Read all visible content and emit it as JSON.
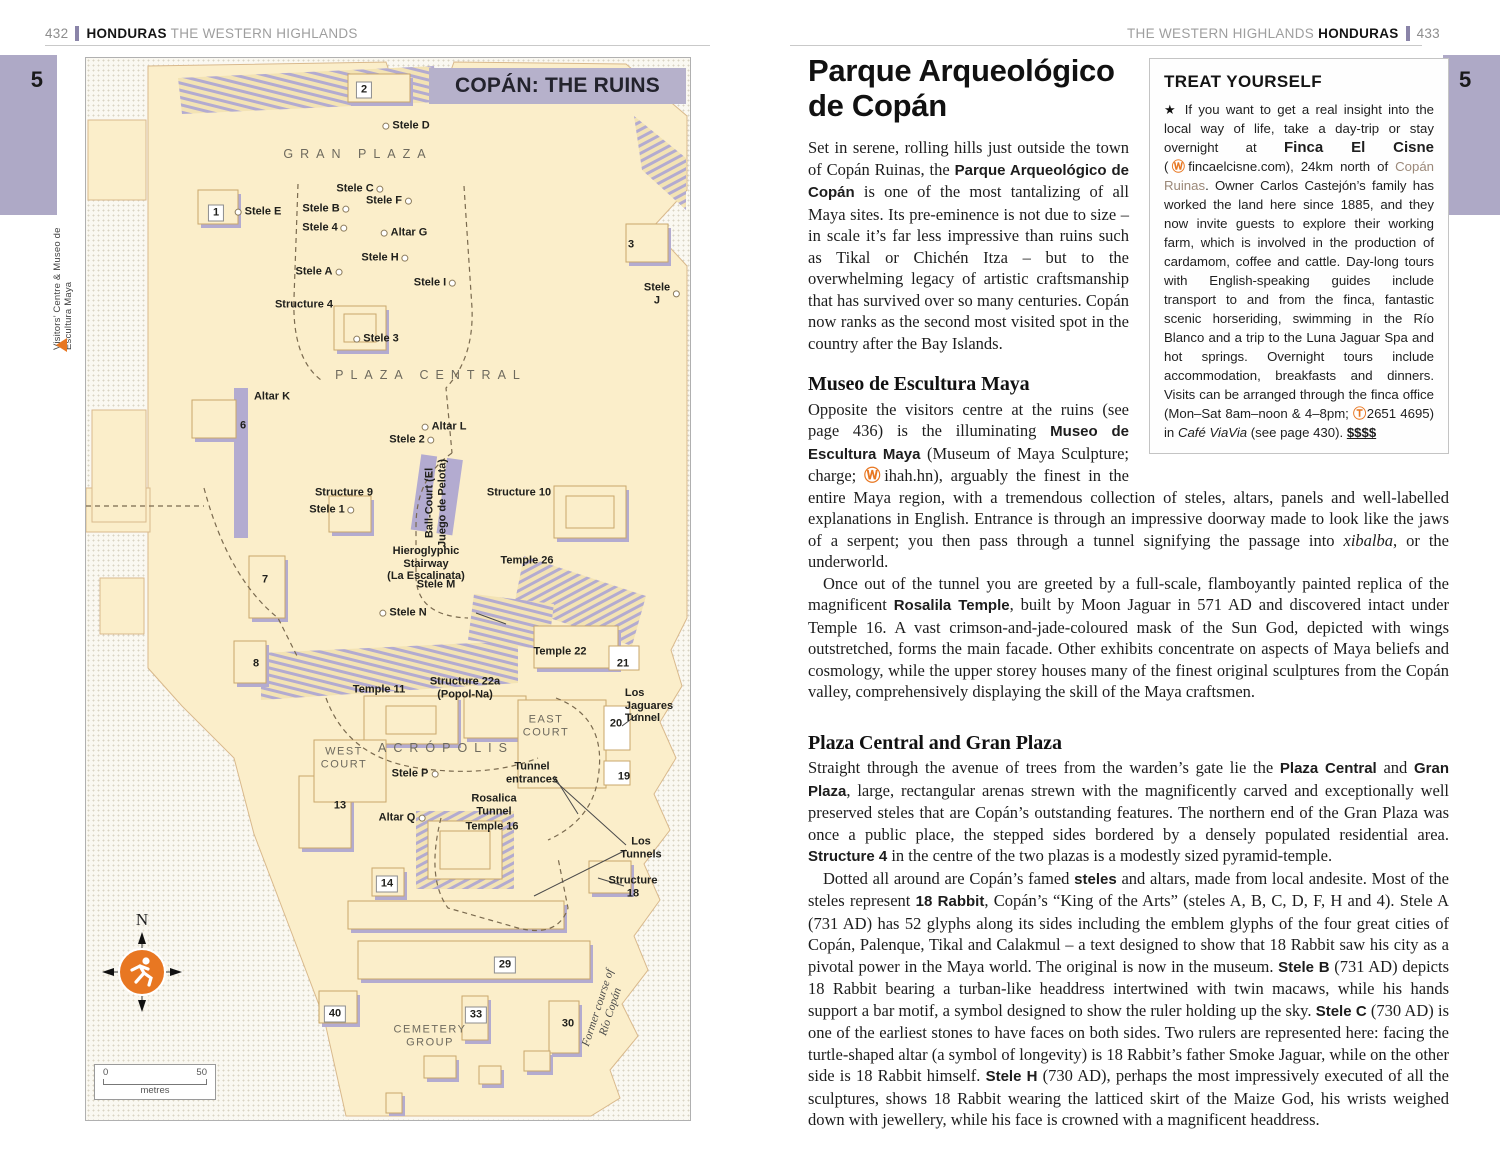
{
  "colors": {
    "accent_orange": "#e87722",
    "tab_purple": "#aea9c6",
    "map_cream": "#fbeeca",
    "map_shadow": "#b3abd0",
    "title_box": "#b6b1cb"
  },
  "page_left": {
    "page_number": "432",
    "header_bold": "HONDURAS",
    "header_light": "THE WESTERN HIGHLANDS",
    "tab": "5",
    "map": {
      "title": "COPÁN: THE RUINS",
      "side_label": "Visitors’ Centre & Museo de Escultura Maya",
      "compass_n": "N",
      "scale_zero": "0",
      "scale_fifty": "50",
      "scale_unit": "metres",
      "labels": [
        {
          "t": "2",
          "cls": "numbox",
          "x": 278,
          "y": 32
        },
        {
          "t": "Stele D",
          "dot": "l",
          "x": 320,
          "y": 68
        },
        {
          "t": "GRAN PLAZA",
          "cls": "area",
          "x": 272,
          "y": 96
        },
        {
          "t": "Stele C",
          "dot": "r",
          "x": 274,
          "y": 131
        },
        {
          "t": "1",
          "cls": "numbox",
          "x": 130,
          "y": 155
        },
        {
          "t": "Stele E",
          "dot": "l",
          "x": 172,
          "y": 154
        },
        {
          "t": "Stele B",
          "dot": "r",
          "x": 240,
          "y": 151
        },
        {
          "t": "Stele F",
          "dot": "r",
          "x": 303,
          "y": 143
        },
        {
          "t": "Stele 4",
          "dot": "r",
          "x": 239,
          "y": 170
        },
        {
          "t": "Altar G",
          "dot": "l",
          "x": 318,
          "y": 175
        },
        {
          "t": "Stele H",
          "dot": "r",
          "x": 299,
          "y": 200
        },
        {
          "t": "Stele A",
          "dot": "r",
          "x": 233,
          "y": 214
        },
        {
          "t": "Stele I",
          "dot": "r",
          "x": 349,
          "y": 225
        },
        {
          "t": "3",
          "x": 545,
          "y": 187
        },
        {
          "t": "Stele J",
          "dot": "r",
          "x": 576,
          "y": 236
        },
        {
          "t": "Structure 4",
          "x": 218,
          "y": 247
        },
        {
          "t": "Stele 3",
          "dot": "l",
          "x": 290,
          "y": 281
        },
        {
          "t": "PLAZA CENTRAL",
          "cls": "area",
          "x": 345,
          "y": 317
        },
        {
          "t": "Altar K",
          "x": 186,
          "y": 339
        },
        {
          "t": "6",
          "x": 157,
          "y": 368
        },
        {
          "t": "Altar L",
          "dot": "l",
          "x": 358,
          "y": 369
        },
        {
          "t": "Stele 2",
          "dot": "r",
          "x": 326,
          "y": 382
        },
        {
          "t": "Structure 9",
          "x": 258,
          "y": 435
        },
        {
          "t": "Ball-Court (El\nJuego de Pelota)",
          "cls": "rot",
          "x": 350,
          "y": 445
        },
        {
          "t": "Structure 10",
          "x": 433,
          "y": 435
        },
        {
          "t": "Stele 1",
          "dot": "r",
          "x": 246,
          "y": 452
        },
        {
          "t": "Hieroglyphic\nStairway\n(La Escalinata)",
          "x": 340,
          "y": 506
        },
        {
          "t": "Temple 26",
          "x": 441,
          "y": 503
        },
        {
          "t": "7",
          "x": 179,
          "y": 522
        },
        {
          "t": "Stele M",
          "x": 350,
          "y": 527
        },
        {
          "t": "Stele N",
          "dot": "l",
          "x": 317,
          "y": 555
        },
        {
          "t": "8",
          "x": 170,
          "y": 606
        },
        {
          "t": "Temple 22",
          "x": 474,
          "y": 594
        },
        {
          "t": "21",
          "x": 537,
          "y": 606
        },
        {
          "t": "Temple 11",
          "x": 293,
          "y": 632
        },
        {
          "t": "Structure 22a\n(Popol-Na)",
          "x": 379,
          "y": 630
        },
        {
          "t": "Los Jaguares\nTunnel",
          "cls": "la",
          "x": 563,
          "y": 648
        },
        {
          "t": "EAST\nCOURT",
          "cls": "court",
          "x": 460,
          "y": 668
        },
        {
          "t": "20",
          "x": 530,
          "y": 666
        },
        {
          "t": "WEST\nCOURT",
          "cls": "court",
          "x": 258,
          "y": 700
        },
        {
          "t": "ACRÓPOLIS",
          "cls": "area",
          "x": 360,
          "y": 690
        },
        {
          "t": "Tunnel\nentrances",
          "x": 446,
          "y": 715
        },
        {
          "t": "19",
          "x": 538,
          "y": 719
        },
        {
          "t": "Stele P",
          "dot": "r",
          "x": 329,
          "y": 716
        },
        {
          "t": "13",
          "x": 254,
          "y": 748
        },
        {
          "t": "Rosalica\nTunnel",
          "x": 408,
          "y": 747
        },
        {
          "t": "Altar Q",
          "dot": "r",
          "x": 316,
          "y": 760
        },
        {
          "t": "Temple 16",
          "x": 406,
          "y": 769
        },
        {
          "t": "Los Tunnels",
          "x": 555,
          "y": 790
        },
        {
          "t": "14",
          "cls": "numbox",
          "x": 301,
          "y": 826
        },
        {
          "t": "Structure 18",
          "x": 547,
          "y": 829
        },
        {
          "t": "29",
          "cls": "numbox",
          "x": 419,
          "y": 907
        },
        {
          "t": "40",
          "cls": "numbox",
          "x": 249,
          "y": 956
        },
        {
          "t": "33",
          "cls": "numbox",
          "x": 390,
          "y": 957
        },
        {
          "t": "CEMETERY\nGROUP",
          "cls": "court",
          "x": 344,
          "y": 978
        },
        {
          "t": "30",
          "x": 482,
          "y": 966
        },
        {
          "t": "Former course of Río Copán",
          "cls": "river",
          "x": 519,
          "y": 952
        }
      ]
    }
  },
  "page_right": {
    "page_number": "433",
    "header_light": "THE WESTERN HIGHLANDS",
    "header_bold": "HONDURAS",
    "tab": "5",
    "title": "Parque Arqueológico de Copán",
    "intro": [
      {
        "t": "Set in serene, rolling hills just outside the town of Copán Ruinas, the "
      },
      {
        "t": "Parque Arqueológico de Copán",
        "c": "b"
      },
      {
        "t": " is one of the most tantalizing of all Maya sites. Its pre-eminence is not due to size – in scale it’s far less impressive than ruins such as Tikal or Chichén Itza – but to the overwhelming legacy of artistic craftsmanship that has survived over so many centuries. Copán now ranks as the second most visited spot in the country after the Bay Islands."
      }
    ],
    "treat_box": {
      "title": "TREAT YOURSELF",
      "body": [
        {
          "t": "★ ",
          "c": "star"
        },
        {
          "t": "If you want to get a real insight into the local way of life, take a day-trip or stay overnight at "
        },
        {
          "t": "Finca El Cisne",
          "c": "b"
        },
        {
          "t": " ("
        },
        {
          "t": "Ⓦ",
          "c": "icon"
        },
        {
          "t": "fincaelcisne.com), 24km north of "
        },
        {
          "t": "Copán Ruinas",
          "c": "link"
        },
        {
          "t": ". Owner Carlos Castejón’s family has worked the land here since 1885, and they now invite guests to explore their working farm, which is involved in the production of cardamom, coffee and cattle. Day-long tours with English-speaking guides include transport to and from the finca, fantastic scenic horseriding, swimming in the Río Blanco and a trip to the Luna Jaguar Spa and hot springs. Overnight tours include accommodation, breakfasts and dinners. Visits can be arranged through the finca office (Mon–Sat 8am–noon & 4–8pm; "
        },
        {
          "t": "Ⓣ",
          "c": "icon"
        },
        {
          "t": "2651 4695) in "
        },
        {
          "t": "Café ViaVia",
          "c": "i"
        },
        {
          "t": " (see page 430). "
        },
        {
          "t": "$$$$",
          "c": "price"
        }
      ]
    },
    "section1": {
      "heading": "Museo de Escultura Maya",
      "p1": [
        {
          "t": "Opposite the visitors centre at the ruins (see page 436) is the illuminating "
        },
        {
          "t": "Museo de Escultura Maya",
          "c": "b"
        },
        {
          "t": " (Museum of Maya Sculpture; charge; "
        },
        {
          "t": "Ⓦ",
          "c": "icon"
        },
        {
          "t": "ihah.hn), arguably the finest in the entire Maya region, with a tremendous collection of steles, altars, panels and well-labelled explanations in English. Entrance is through an impressive doorway made to look like the jaws of a serpent; you then pass through a tunnel signifying the passage into "
        },
        {
          "t": "xibalba",
          "c": "i"
        },
        {
          "t": ", or the underworld."
        }
      ],
      "p2": [
        {
          "t": "Once out of the tunnel you are greeted by a full-scale, flamboyantly painted replica of the magnificent "
        },
        {
          "t": "Rosalila Temple",
          "c": "b"
        },
        {
          "t": ", built by Moon Jaguar in 571 AD and discovered intact under Temple 16. A vast crimson-and-jade-coloured mask of the Sun God, depicted with wings outstretched, forms the main facade. Other exhibits concentrate on aspects of Maya beliefs and cosmology, while the upper storey houses many of the finest original sculptures from the Copán valley, comprehensively displaying the skill of the Maya craftsmen."
        }
      ]
    },
    "section2": {
      "heading": "Plaza Central and Gran Plaza",
      "p1": [
        {
          "t": "Straight through the avenue of trees from the warden’s gate lie the "
        },
        {
          "t": "Plaza Central",
          "c": "b"
        },
        {
          "t": " and "
        },
        {
          "t": "Gran Plaza",
          "c": "b"
        },
        {
          "t": ", large, rectangular arenas strewn with the magnificently carved and exceptionally well preserved steles that are Copán’s outstanding features. The northern end of the Gran Plaza was once a public place, the stepped sides bordered by a densely populated residential area. "
        },
        {
          "t": "Structure 4",
          "c": "b"
        },
        {
          "t": " in the centre of the two plazas is a modestly sized pyramid-temple."
        }
      ],
      "p2": [
        {
          "t": "Dotted all around are Copán’s famed "
        },
        {
          "t": "steles",
          "c": "b"
        },
        {
          "t": " and altars, made from local andesite. Most of the steles represent "
        },
        {
          "t": "18 Rabbit",
          "c": "b"
        },
        {
          "t": ", Copán’s “King of the Arts” (steles A, B, C, D, F, H and 4). Stele A (731 AD) has 52 glyphs along its sides including the emblem glyphs of the four great cities of Copán, Palenque, Tikal and Calakmul – a text designed to show that 18 Rabbit saw his city as a pivotal power in the Maya world. The original is now in the museum. "
        },
        {
          "t": "Stele B",
          "c": "b"
        },
        {
          "t": " (731 AD) depicts 18 Rabbit bearing a turban-like headdress intertwined with twin macaws, while his hands support a bar motif, a symbol designed to show the ruler holding up the sky. "
        },
        {
          "t": "Stele C",
          "c": "b"
        },
        {
          "t": " (730 AD) is one of the earliest stones to have faces on both sides. Two rulers are represented here: facing the turtle-shaped altar (a symbol of longevity) is 18 Rabbit’s father Smoke Jaguar, while on the other side is 18 Rabbit himself. "
        },
        {
          "t": "Stele H",
          "c": "b"
        },
        {
          "t": " (730 AD), perhaps the most impressively executed of all the sculptures, shows 18 Rabbit wearing the latticed skirt of the Maize God, his wrists weighed down with jewellery, while his face is crowned with a magnificent headdress."
        }
      ]
    }
  }
}
